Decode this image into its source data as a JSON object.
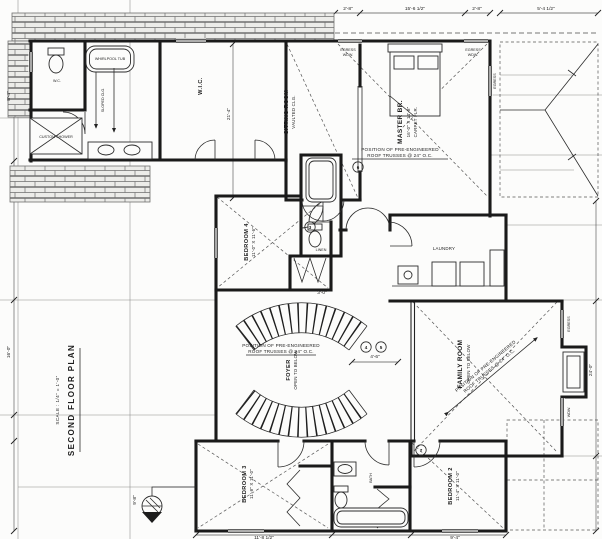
{
  "title": {
    "main": "SECOND FLOOR PLAN",
    "scale": "SCALE : 1/4\" = 1'-0\""
  },
  "rooms": {
    "master": {
      "name": "MASTER BR.",
      "size": "16'-0\" X 14'-8\"",
      "floor": "CARPET FLR."
    },
    "sitting": {
      "name": "SITTING ROOM",
      "size": "VAULTED CLG."
    },
    "wic": {
      "name": "W.I.C."
    },
    "family": {
      "name": "FAMILY ROOM",
      "size": "OPEN TO BELOW"
    },
    "foyer": {
      "name": "FOYER",
      "size": "OPEN TO BELOW"
    },
    "bedroom2": {
      "name": "BEDROOM 2",
      "size": "11'-4\" X 11'-0\""
    },
    "bedroom3": {
      "name": "BEDROOM 3",
      "size": "11'-8\" X 11'-0\""
    },
    "bedroom4": {
      "name": "BEDROOM 4",
      "size": "11'-0\" X 11'-6\""
    },
    "bath": {
      "name": "BATH"
    },
    "laundry": {
      "name": "LAUNDRY"
    },
    "shower": {
      "name": "CUSTOM SHOWER"
    },
    "tub": {
      "name": "WHIRLPOOL TUB"
    },
    "linen": {
      "name": "LINEN"
    },
    "wc": {
      "name": "W.C."
    }
  },
  "notes": {
    "truss_line1": "POSITION OF PRE-ENGINEERED",
    "truss_line2": "ROOF TRUSSES @ 24\" O.C.",
    "slope": "SLOPED CLG.",
    "egress1": "EGRESS",
    "egress2": "WDW."
  },
  "tags": {
    "t3": "3",
    "t4": "4",
    "t5": "5",
    "t6": "6",
    "t7": "7"
  },
  "dims": [
    {
      "text": "2'-8\""
    },
    {
      "text": "15'-6 1/2\""
    },
    {
      "text": "2'-8\""
    },
    {
      "text": "5'-4 1/2\""
    },
    {
      "text": "8'-4\""
    },
    {
      "text": "16'-0\""
    },
    {
      "text": "21'-4\""
    },
    {
      "text": "4'-6\""
    },
    {
      "text": "9'-8\""
    },
    {
      "text": "24'-0\""
    },
    {
      "text": "11'-8 1/2\""
    },
    {
      "text": "9'-4\""
    },
    {
      "text": "3'-0\""
    }
  ]
}
